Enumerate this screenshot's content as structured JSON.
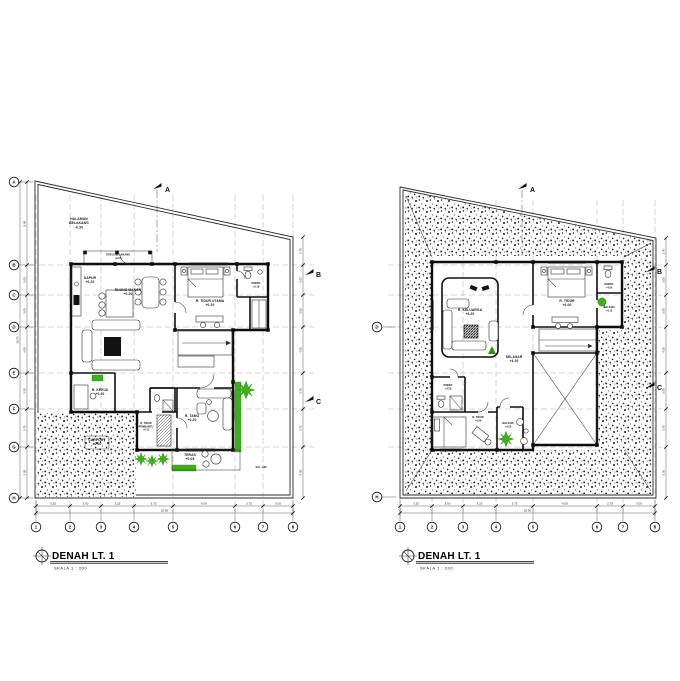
{
  "sheet": {
    "background": "#ffffff",
    "ink": "#111111",
    "accent_green": "#3fae1e",
    "accent_green_dark": "#2e8f12"
  },
  "left_plan": {
    "title": "DENAH LT. 1",
    "scale_label": "SKALA 1 : 200",
    "section_markers": {
      "top": "A",
      "right_upper": "B",
      "right_lower": "C"
    },
    "grid": {
      "cols": [
        "1",
        "2",
        "3",
        "4",
        "5",
        "6",
        "7",
        "8"
      ],
      "rows": [
        "A",
        "B",
        "C",
        "D",
        "E",
        "F",
        "G",
        "H"
      ],
      "dims_bottom": [
        "3.25",
        "3.00",
        "3.25",
        "3.75",
        "6.00",
        "2.75",
        "3.00"
      ],
      "dims_bottom_total": "25.00",
      "dims_left": [
        "8.00",
        "3.00",
        "3.00",
        "4.50",
        "3.50",
        "3.75",
        "5.00"
      ],
      "dims_left_total": "30.75",
      "dims_right": [
        "2.70",
        "3.00",
        "3.00",
        "4.50",
        "3.50",
        "3.75",
        "5.00"
      ]
    },
    "rooms": [
      {
        "id": "halaman-belakang",
        "label": "HALAMAN\nBELAKANG\n-0.30"
      },
      {
        "id": "teras-belakang",
        "label": "TERAS BELAKANG\n+0.05"
      },
      {
        "id": "dapur",
        "label": "DAPUR\n+0.20"
      },
      {
        "id": "ruang-makan",
        "label": "RUANG MAKAN\n+0.20"
      },
      {
        "id": "r-tidur-utama",
        "label": "R. TIDUR UTAMA\n+0.20"
      },
      {
        "id": "km-wc",
        "label": "KM/WC\n+0.18"
      },
      {
        "id": "r-kerja",
        "label": "R. KERJA\n+0.20"
      },
      {
        "id": "r-tidur-pembantu",
        "label": "R. TIDUR\nPEMBANTU\n+0.15"
      },
      {
        "id": "r-tamu",
        "label": "R. TAMU\n+0.20"
      },
      {
        "id": "teras",
        "label": "TERAS\n+0.05"
      },
      {
        "id": "carport",
        "label": "CARPORT\n±0.00"
      },
      {
        "id": "sal-air",
        "label": "SAL. AIR"
      }
    ]
  },
  "right_plan": {
    "title": "DENAH LT. 1",
    "scale_label": "SKALA 1 : 200",
    "section_markers": {
      "top": "A",
      "right_upper": "B",
      "right_lower": "C"
    },
    "grid": {
      "cols": [
        "1",
        "2",
        "3",
        "4",
        "5",
        "6",
        "7",
        "8"
      ],
      "rows_visible": [
        "D",
        "H"
      ],
      "dims_bottom": [
        "3.25",
        "3.00",
        "3.25",
        "3.75",
        "6.00",
        "2.75",
        "3.00"
      ],
      "dims_bottom_total": "25.00",
      "dims_right": [
        "2.70",
        "3.00",
        "3.00",
        "4.50",
        "3.50",
        "3.75",
        "5.00"
      ]
    },
    "rooms": [
      {
        "id": "r-keluarga",
        "label": "R. KELUARGA\n+4.20"
      },
      {
        "id": "selasar",
        "label": "SELASAR\n+4.20"
      },
      {
        "id": "r-tidur-1",
        "label": "R. TIDUR\n+4.00"
      },
      {
        "id": "km-wc-1",
        "label": "KM/WC\n+4.00"
      },
      {
        "id": "balkon-1",
        "label": "BALKON\n+4.15"
      },
      {
        "id": "km-wc-2",
        "label": "KM/WC\n+4.20"
      },
      {
        "id": "r-tidur-2",
        "label": "R. TIDUR\n+4.20"
      },
      {
        "id": "balkon-2",
        "label": "BALKON\n+4.20"
      }
    ]
  }
}
